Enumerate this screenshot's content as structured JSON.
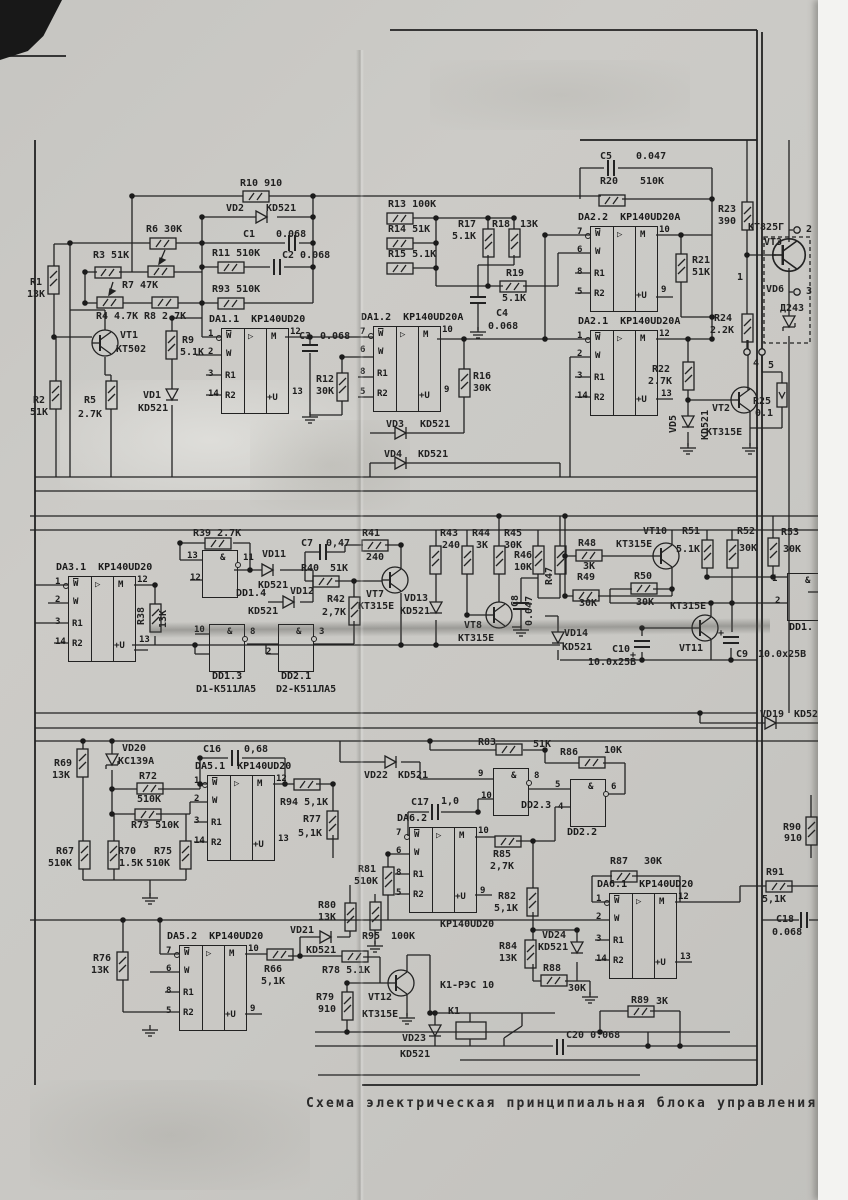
{
  "meta": {
    "caption": "Схема электрическая принципиальная блока управления полуав",
    "paper_color": "#c9c8c4",
    "ink_color": "#222222"
  },
  "opamp_template": {
    "inv": "W",
    "nin": "W",
    "r1": "R1",
    "r2": "R2",
    "tri": "▷",
    "m": "M",
    "pu": "+U"
  },
  "gate_symbol": "&",
  "opamps": [
    {
      "name": "DA1.1",
      "part": "KP140UD20",
      "x": 221,
      "y": 328,
      "pins": [
        "1",
        "2",
        "3",
        "14"
      ],
      "out": "12",
      "pwr": "13"
    },
    {
      "name": "DA1.2",
      "part": "KP140UD20A",
      "x": 373,
      "y": 326,
      "pins": [
        "7",
        "6",
        "8",
        "5"
      ],
      "out": "10",
      "pwr": "9"
    },
    {
      "name": "DA2.2",
      "part": "KP140UD20A",
      "x": 590,
      "y": 226,
      "pins": [
        "7",
        "6",
        "8",
        "5"
      ],
      "out": "10",
      "pwr": "9"
    },
    {
      "name": "DA2.1",
      "part": "KP140UD20A",
      "x": 590,
      "y": 330,
      "pins": [
        "1",
        "2",
        "3",
        "14"
      ],
      "out": "12",
      "pwr": "13"
    },
    {
      "name": "DA3.1",
      "part": "KP140UD20",
      "x": 68,
      "y": 576,
      "pins": [
        "1",
        "2",
        "3",
        "14"
      ],
      "out": "12",
      "pwr": "13"
    },
    {
      "name": "DA5.1",
      "part": "KP140UD20",
      "x": 207,
      "y": 775,
      "pins": [
        "1",
        "2",
        "3",
        "14"
      ],
      "out": "12",
      "pwr": "13"
    },
    {
      "name": "DA6.2",
      "part": "",
      "x": 409,
      "y": 827,
      "pins": [
        "7",
        "6",
        "8",
        "5"
      ],
      "out": "10",
      "pwr": "9"
    },
    {
      "name": "DA6.1",
      "part": "KP140UD20",
      "x": 609,
      "y": 893,
      "pins": [
        "1",
        "2",
        "3",
        "14"
      ],
      "out": "12",
      "pwr": "13"
    },
    {
      "name": "DA5.2",
      "part": "KP140UD20",
      "x": 179,
      "y": 945,
      "pins": [
        "7",
        "6",
        "8",
        "5"
      ],
      "out": "10",
      "pwr": "9"
    }
  ],
  "gates": [
    {
      "label": "DD1.4",
      "x": 202,
      "y": 550,
      "in": [
        "13",
        "12"
      ],
      "out": "11",
      "lx": 236,
      "ly": 588
    },
    {
      "label": "DD1.3",
      "x": 209,
      "y": 624,
      "in": [
        "10",
        ""
      ],
      "out": "8",
      "lx": 212,
      "ly": 671
    },
    {
      "label": "DD2.1",
      "x": 278,
      "y": 624,
      "in": [
        "",
        "2"
      ],
      "out": "3",
      "lx": 281,
      "ly": 671
    },
    {
      "label": "DD2.3",
      "x": 493,
      "y": 768,
      "in": [
        "9",
        "10"
      ],
      "out": "8",
      "lx": 521,
      "ly": 800
    },
    {
      "label": "DD2.2",
      "x": 570,
      "y": 779,
      "in": [
        "5",
        "4"
      ],
      "out": "6",
      "lx": 567,
      "ly": 827
    },
    {
      "label": "DD1.",
      "x": 787,
      "y": 573,
      "in": [
        "1",
        "2"
      ],
      "out": "",
      "lx": 789,
      "ly": 622
    }
  ],
  "labels": [
    {
      "t": "R10 910",
      "x": 240,
      "y": 178
    },
    {
      "t": "VD2",
      "x": 226,
      "y": 203
    },
    {
      "t": "KD521",
      "x": 266,
      "y": 203
    },
    {
      "t": "C1",
      "x": 243,
      "y": 229
    },
    {
      "t": "0.068",
      "x": 276,
      "y": 229
    },
    {
      "t": "R6 30K",
      "x": 146,
      "y": 224
    },
    {
      "t": "R3 51K",
      "x": 93,
      "y": 250
    },
    {
      "t": "R7 47K",
      "x": 122,
      "y": 280
    },
    {
      "t": "R11 510K",
      "x": 212,
      "y": 248
    },
    {
      "t": "C2 0.068",
      "x": 282,
      "y": 250
    },
    {
      "t": "R93 510K",
      "x": 212,
      "y": 284
    },
    {
      "t": "R4 4.7K",
      "x": 96,
      "y": 311
    },
    {
      "t": "R8 2.7K",
      "x": 144,
      "y": 311
    },
    {
      "t": "R1",
      "x": 30,
      "y": 277
    },
    {
      "t": "13K",
      "x": 27,
      "y": 289
    },
    {
      "t": "VT1",
      "x": 120,
      "y": 330
    },
    {
      "t": "KT502",
      "x": 116,
      "y": 344
    },
    {
      "t": "R2",
      "x": 33,
      "y": 395
    },
    {
      "t": "51K",
      "x": 30,
      "y": 407
    },
    {
      "t": "R5",
      "x": 84,
      "y": 395
    },
    {
      "t": "2.7K",
      "x": 78,
      "y": 409
    },
    {
      "t": "VD1",
      "x": 143,
      "y": 390
    },
    {
      "t": "KD521",
      "x": 138,
      "y": 403
    },
    {
      "t": "R9",
      "x": 182,
      "y": 335
    },
    {
      "t": "5.1K",
      "x": 180,
      "y": 347
    },
    {
      "t": "C3",
      "x": 299,
      "y": 331
    },
    {
      "t": "0.068",
      "x": 320,
      "y": 331
    },
    {
      "t": "R12",
      "x": 316,
      "y": 374
    },
    {
      "t": "30K",
      "x": 316,
      "y": 386
    },
    {
      "t": "R16",
      "x": 473,
      "y": 371
    },
    {
      "t": "30K",
      "x": 473,
      "y": 383
    },
    {
      "t": "VD3",
      "x": 386,
      "y": 419
    },
    {
      "t": "KD521",
      "x": 420,
      "y": 419
    },
    {
      "t": "VD4",
      "x": 384,
      "y": 449
    },
    {
      "t": "KD521",
      "x": 418,
      "y": 449
    },
    {
      "t": "R13 100K",
      "x": 388,
      "y": 199
    },
    {
      "t": "R14 51K",
      "x": 388,
      "y": 224
    },
    {
      "t": "R15 5.1K",
      "x": 388,
      "y": 249
    },
    {
      "t": "R17",
      "x": 458,
      "y": 219
    },
    {
      "t": "5.1K",
      "x": 452,
      "y": 231
    },
    {
      "t": "R18",
      "x": 492,
      "y": 219
    },
    {
      "t": "13K",
      "x": 520,
      "y": 219
    },
    {
      "t": "R19",
      "x": 506,
      "y": 268
    },
    {
      "t": "5.1K",
      "x": 502,
      "y": 293
    },
    {
      "t": "C4",
      "x": 496,
      "y": 308
    },
    {
      "t": "0.068",
      "x": 488,
      "y": 321
    },
    {
      "t": "C5",
      "x": 600,
      "y": 151
    },
    {
      "t": "0.047",
      "x": 636,
      "y": 151
    },
    {
      "t": "R20",
      "x": 600,
      "y": 176
    },
    {
      "t": "510K",
      "x": 640,
      "y": 176
    },
    {
      "t": "R21",
      "x": 692,
      "y": 255
    },
    {
      "t": "51K",
      "x": 692,
      "y": 267
    },
    {
      "t": "R23",
      "x": 718,
      "y": 204
    },
    {
      "t": "390",
      "x": 718,
      "y": 216
    },
    {
      "t": "КТ825Г",
      "x": 748,
      "y": 222
    },
    {
      "t": "VT3",
      "x": 764,
      "y": 237
    },
    {
      "t": "VD6",
      "x": 766,
      "y": 284
    },
    {
      "t": "Д243",
      "x": 780,
      "y": 303
    },
    {
      "t": "2",
      "x": 806,
      "y": 224
    },
    {
      "t": "3",
      "x": 806,
      "y": 286
    },
    {
      "t": "1",
      "x": 737,
      "y": 272
    },
    {
      "t": "4",
      "x": 753,
      "y": 358
    },
    {
      "t": "5",
      "x": 768,
      "y": 360
    },
    {
      "t": "R24",
      "x": 714,
      "y": 313
    },
    {
      "t": "2.2K",
      "x": 710,
      "y": 325
    },
    {
      "t": "R22",
      "x": 652,
      "y": 364
    },
    {
      "t": "2.7K",
      "x": 648,
      "y": 376
    },
    {
      "t": "VD5",
      "x": 668,
      "y": 433,
      "r": -90
    },
    {
      "t": "KD521",
      "x": 700,
      "y": 440,
      "r": -90
    },
    {
      "t": "VT2",
      "x": 712,
      "y": 403
    },
    {
      "t": "KT315E",
      "x": 706,
      "y": 427
    },
    {
      "t": "R25",
      "x": 753,
      "y": 396
    },
    {
      "t": "0.1",
      "x": 755,
      "y": 408
    },
    {
      "t": "R39 2.7K",
      "x": 193,
      "y": 528
    },
    {
      "t": "R38",
      "x": 136,
      "y": 625,
      "r": -90
    },
    {
      "t": "13K",
      "x": 158,
      "y": 628,
      "r": -90
    },
    {
      "t": "VD11",
      "x": 262,
      "y": 549
    },
    {
      "t": "KD521",
      "x": 258,
      "y": 580
    },
    {
      "t": "VD12",
      "x": 290,
      "y": 586
    },
    {
      "t": "KD521",
      "x": 248,
      "y": 606
    },
    {
      "t": "C7",
      "x": 301,
      "y": 538
    },
    {
      "t": "0,47",
      "x": 326,
      "y": 538
    },
    {
      "t": "R41",
      "x": 362,
      "y": 528
    },
    {
      "t": "240",
      "x": 366,
      "y": 552
    },
    {
      "t": "R40",
      "x": 301,
      "y": 563
    },
    {
      "t": "51K",
      "x": 330,
      "y": 563
    },
    {
      "t": "R42",
      "x": 327,
      "y": 594
    },
    {
      "t": "2,7K",
      "x": 322,
      "y": 607
    },
    {
      "t": "VT7",
      "x": 366,
      "y": 589
    },
    {
      "t": "KT315E",
      "x": 358,
      "y": 601
    },
    {
      "t": "VD13",
      "x": 404,
      "y": 593
    },
    {
      "t": "KD521",
      "x": 400,
      "y": 606
    },
    {
      "t": "R43",
      "x": 440,
      "y": 528
    },
    {
      "t": "240",
      "x": 442,
      "y": 540
    },
    {
      "t": "R44",
      "x": 472,
      "y": 528
    },
    {
      "t": "3K",
      "x": 476,
      "y": 540
    },
    {
      "t": "R45",
      "x": 504,
      "y": 528
    },
    {
      "t": "30K",
      "x": 504,
      "y": 540
    },
    {
      "t": "R46",
      "x": 514,
      "y": 550
    },
    {
      "t": "10K",
      "x": 514,
      "y": 562
    },
    {
      "t": "R47",
      "x": 544,
      "y": 585,
      "r": -90
    },
    {
      "t": "C8",
      "x": 510,
      "y": 607,
      "r": -90
    },
    {
      "t": "0.047",
      "x": 524,
      "y": 626,
      "r": -90
    },
    {
      "t": "VT8",
      "x": 464,
      "y": 620
    },
    {
      "t": "KT315E",
      "x": 458,
      "y": 633
    },
    {
      "t": "VD14",
      "x": 564,
      "y": 628
    },
    {
      "t": "KD521",
      "x": 562,
      "y": 642
    },
    {
      "t": "R48",
      "x": 578,
      "y": 538
    },
    {
      "t": "3K",
      "x": 583,
      "y": 561
    },
    {
      "t": "R49",
      "x": 577,
      "y": 572
    },
    {
      "t": "30K",
      "x": 579,
      "y": 598
    },
    {
      "t": "R50",
      "x": 634,
      "y": 571
    },
    {
      "t": "30K",
      "x": 636,
      "y": 597
    },
    {
      "t": "VT10",
      "x": 643,
      "y": 526
    },
    {
      "t": "KT315E",
      "x": 616,
      "y": 539
    },
    {
      "t": "R51",
      "x": 682,
      "y": 526
    },
    {
      "t": "5.1K",
      "x": 676,
      "y": 544
    },
    {
      "t": "R52",
      "x": 737,
      "y": 526
    },
    {
      "t": "30K",
      "x": 739,
      "y": 543
    },
    {
      "t": "R53",
      "x": 781,
      "y": 527
    },
    {
      "t": "30K",
      "x": 783,
      "y": 544
    },
    {
      "t": "VT11",
      "x": 679,
      "y": 643
    },
    {
      "t": "KT315E",
      "x": 670,
      "y": 601
    },
    {
      "t": "C10",
      "x": 612,
      "y": 644
    },
    {
      "t": "10.0x25В",
      "x": 588,
      "y": 657
    },
    {
      "t": "C9",
      "x": 736,
      "y": 649
    },
    {
      "t": "10.0x25В",
      "x": 758,
      "y": 649
    },
    {
      "t": "+",
      "x": 630,
      "y": 650
    },
    {
      "t": "+",
      "x": 718,
      "y": 628
    },
    {
      "t": "D1-К511ЛА5",
      "x": 196,
      "y": 684
    },
    {
      "t": "D2-К511ЛА5",
      "x": 276,
      "y": 684
    },
    {
      "t": "VD19",
      "x": 760,
      "y": 709
    },
    {
      "t": "KD521",
      "x": 794,
      "y": 709
    },
    {
      "t": "VD20",
      "x": 122,
      "y": 743
    },
    {
      "t": "KC139A",
      "x": 118,
      "y": 756
    },
    {
      "t": "R69",
      "x": 54,
      "y": 758
    },
    {
      "t": "13K",
      "x": 52,
      "y": 770
    },
    {
      "t": "C16",
      "x": 203,
      "y": 744
    },
    {
      "t": "0,68",
      "x": 244,
      "y": 744
    },
    {
      "t": "R72",
      "x": 139,
      "y": 771
    },
    {
      "t": "510K",
      "x": 137,
      "y": 794
    },
    {
      "t": "R73 510K",
      "x": 131,
      "y": 820
    },
    {
      "t": "R67",
      "x": 56,
      "y": 846
    },
    {
      "t": "510K",
      "x": 48,
      "y": 858
    },
    {
      "t": "R70",
      "x": 118,
      "y": 846
    },
    {
      "t": "1.5K",
      "x": 119,
      "y": 858
    },
    {
      "t": "R75",
      "x": 154,
      "y": 846
    },
    {
      "t": "510K",
      "x": 146,
      "y": 858
    },
    {
      "t": "R94 5,1K",
      "x": 280,
      "y": 797
    },
    {
      "t": "R77",
      "x": 303,
      "y": 814
    },
    {
      "t": "5,1K",
      "x": 298,
      "y": 828
    },
    {
      "t": "VD22",
      "x": 364,
      "y": 770
    },
    {
      "t": "KD521",
      "x": 398,
      "y": 770
    },
    {
      "t": "R83",
      "x": 478,
      "y": 737
    },
    {
      "t": "51K",
      "x": 533,
      "y": 739
    },
    {
      "t": "R86",
      "x": 560,
      "y": 747
    },
    {
      "t": "10K",
      "x": 604,
      "y": 745
    },
    {
      "t": "C17",
      "x": 411,
      "y": 797
    },
    {
      "t": "1,0",
      "x": 441,
      "y": 796
    },
    {
      "t": "KP140UD20",
      "x": 440,
      "y": 919
    },
    {
      "t": "R81",
      "x": 358,
      "y": 864
    },
    {
      "t": "510K",
      "x": 354,
      "y": 876
    },
    {
      "t": "R85",
      "x": 493,
      "y": 849
    },
    {
      "t": "2,7K",
      "x": 490,
      "y": 861
    },
    {
      "t": "R82",
      "x": 498,
      "y": 891
    },
    {
      "t": "5,1K",
      "x": 494,
      "y": 903
    },
    {
      "t": "R95",
      "x": 362,
      "y": 931
    },
    {
      "t": "100K",
      "x": 391,
      "y": 931
    },
    {
      "t": "R87",
      "x": 610,
      "y": 856
    },
    {
      "t": "30K",
      "x": 644,
      "y": 856
    },
    {
      "t": "R91",
      "x": 766,
      "y": 867
    },
    {
      "t": "5,1K",
      "x": 762,
      "y": 894
    },
    {
      "t": "C18",
      "x": 776,
      "y": 914
    },
    {
      "t": "0.068",
      "x": 772,
      "y": 927
    },
    {
      "t": "R90",
      "x": 783,
      "y": 822
    },
    {
      "t": "910",
      "x": 784,
      "y": 833
    },
    {
      "t": "R89",
      "x": 631,
      "y": 995
    },
    {
      "t": "3K",
      "x": 656,
      "y": 996
    },
    {
      "t": "R76",
      "x": 93,
      "y": 953
    },
    {
      "t": "13K",
      "x": 91,
      "y": 965
    },
    {
      "t": "VD21",
      "x": 290,
      "y": 925
    },
    {
      "t": "KD521",
      "x": 306,
      "y": 945
    },
    {
      "t": "R80",
      "x": 318,
      "y": 900
    },
    {
      "t": "13K",
      "x": 318,
      "y": 912
    },
    {
      "t": "R66",
      "x": 264,
      "y": 964
    },
    {
      "t": "5,1K",
      "x": 261,
      "y": 976
    },
    {
      "t": "R78 5.1K",
      "x": 322,
      "y": 965
    },
    {
      "t": "R79",
      "x": 316,
      "y": 992
    },
    {
      "t": "910",
      "x": 318,
      "y": 1004
    },
    {
      "t": "VT12",
      "x": 368,
      "y": 992
    },
    {
      "t": "KT315E",
      "x": 362,
      "y": 1009
    },
    {
      "t": "K1-РЭС 10",
      "x": 440,
      "y": 980
    },
    {
      "t": "K1",
      "x": 448,
      "y": 1006
    },
    {
      "t": "VD23",
      "x": 402,
      "y": 1033
    },
    {
      "t": "KD521",
      "x": 400,
      "y": 1049
    },
    {
      "t": "C20 0.068",
      "x": 566,
      "y": 1030
    },
    {
      "t": "R84",
      "x": 499,
      "y": 941
    },
    {
      "t": "13K",
      "x": 499,
      "y": 953
    },
    {
      "t": "VD24",
      "x": 542,
      "y": 930
    },
    {
      "t": "KD521",
      "x": 538,
      "y": 942
    },
    {
      "t": "R88",
      "x": 543,
      "y": 963
    },
    {
      "t": "30K",
      "x": 568,
      "y": 983
    }
  ]
}
